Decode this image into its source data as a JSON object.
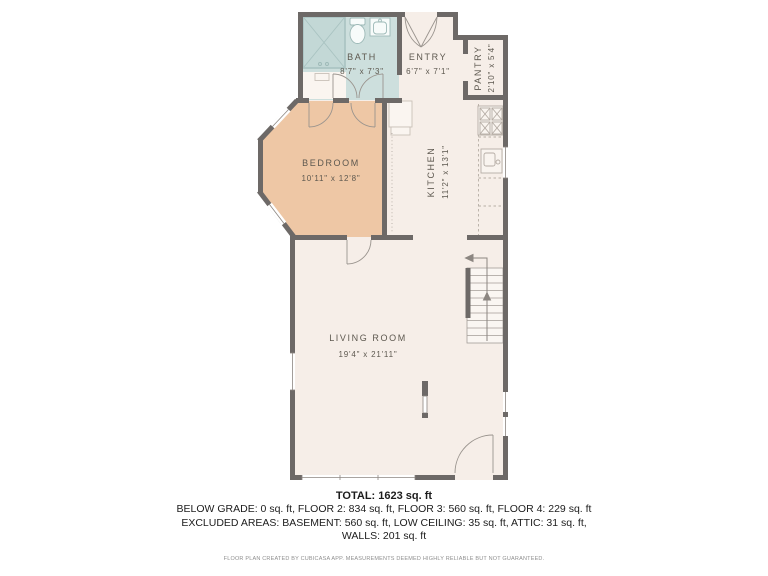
{
  "rooms": {
    "bath": {
      "name": "BATH",
      "dims": "8'7\" x 7'3\""
    },
    "entry": {
      "name": "ENTRY",
      "dims": "6'7\" x 7'1\""
    },
    "pantry": {
      "name": "PANTRY",
      "dims": "2'10\" x 5'4\""
    },
    "bedroom": {
      "name": "BEDROOM",
      "dims": "10'11\" x 12'8\""
    },
    "kitchen": {
      "name": "KITCHEN",
      "dims": "11'2\" x 13'1\""
    },
    "living": {
      "name": "LIVING ROOM",
      "dims": "19'4\" x 21'11\""
    }
  },
  "fixtures": [
    "shower-icon",
    "toilet-icon",
    "bath-sink-icon",
    "stove-icon",
    "kitchen-sink-icon",
    "fridge-icon",
    "stairs-up-icon",
    "fireplace-icon"
  ],
  "summary": {
    "total": "TOTAL: 1623 sq. ft",
    "lines": [
      "BELOW GRADE: 0 sq. ft, FLOOR 2: 834 sq. ft, FLOOR 3: 560 sq. ft, FLOOR 4: 229 sq. ft",
      "EXCLUDED AREAS: BASEMENT: 560 sq. ft, LOW CEILING: 35 sq. ft, ATTIC: 31 sq. ft,",
      "WALLS: 201 sq. ft"
    ],
    "disclaimer": "FLOOR PLAN CREATED BY CUBICASA APP. MEASUREMENTS DEEMED HIGHLY RELIABLE BUT NOT GUARANTEED."
  },
  "colors": {
    "wall": "#6d6967",
    "floor": "#f6eee8",
    "bedroom_floor": "#eec7a5",
    "bath_floor": "#cddfdd",
    "label_text": "#5d584f"
  }
}
